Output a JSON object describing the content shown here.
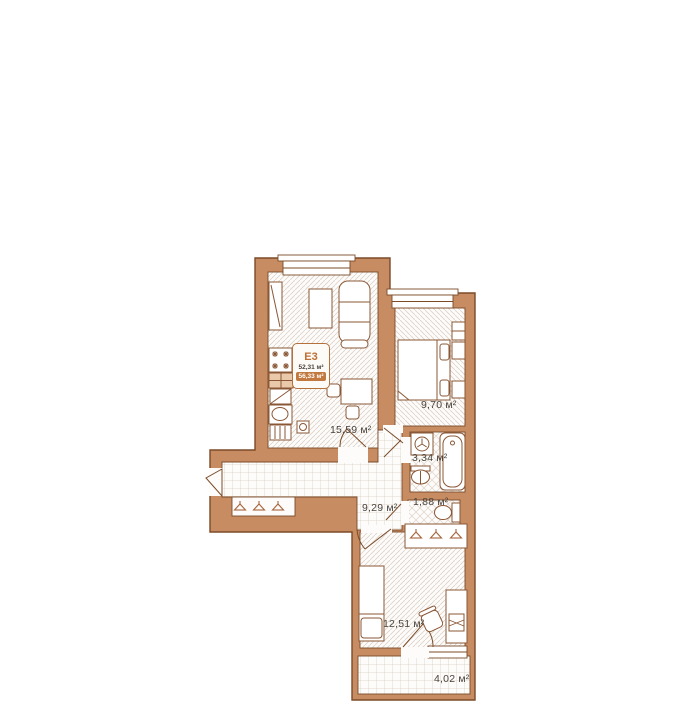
{
  "plan": {
    "badge": {
      "unit": "E3",
      "area_main": "52,31 м²",
      "area_with_balcony": "56,33 м²"
    },
    "rooms": [
      {
        "id": "kitchen-living",
        "area": "15,59 м²"
      },
      {
        "id": "bedroom",
        "area": "9,70 м²"
      },
      {
        "id": "bathroom",
        "area": "3,34 м²"
      },
      {
        "id": "toilet",
        "area": "1,88 м²"
      },
      {
        "id": "hallway",
        "area": "9,29 м²"
      },
      {
        "id": "bedroom-2",
        "area": "12,51 м²"
      },
      {
        "id": "balcony",
        "area": "4,02 м²"
      }
    ],
    "colors": {
      "wall": "#c78c62",
      "wall_outline": "#7b4b28",
      "accent": "#c1793f"
    }
  }
}
